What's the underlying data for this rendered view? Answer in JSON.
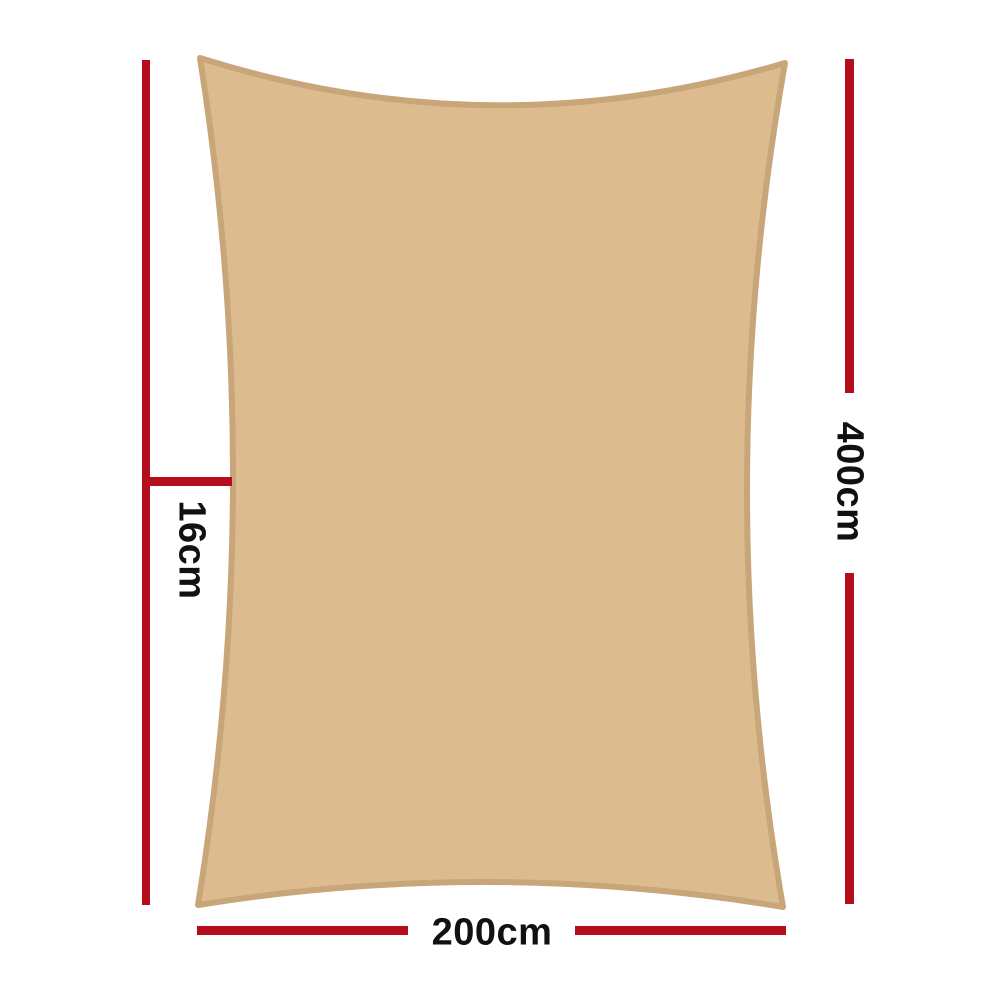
{
  "diagram": {
    "labels": {
      "edge_drop": "16cm",
      "height": "400cm",
      "width": "200cm"
    },
    "colors": {
      "sail_fill": "#dcbc8e",
      "sail_border": "#c8a679",
      "dimension_line": "#b60d1c",
      "label_text": "#111111",
      "background": "#ffffff"
    }
  }
}
